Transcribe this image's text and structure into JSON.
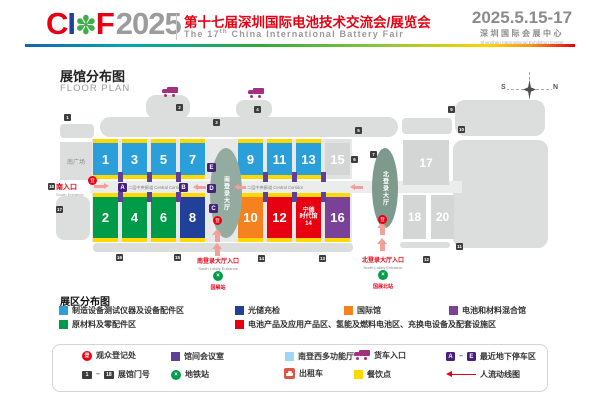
{
  "header": {
    "logo": {
      "c": "C",
      "i": "I",
      "flower": "✽",
      "f": "F",
      "year": "2025"
    },
    "title_cn": "第十七届深圳国际电池技术交流会/展览会",
    "title_en_prefix": "The 17",
    "title_en_sup": "th",
    "title_en_suffix": " China International Battery Fair",
    "date": "2025.5.15-17",
    "venue_cn": "深圳国际会展中心",
    "venue_en": "Shenzhen International Exhibition Center"
  },
  "floorplan": {
    "title_cn": "展馆分布图",
    "title_en": "FLOOR PLAN",
    "compass": {
      "s": "S",
      "n": "N"
    },
    "south_plaza": "南广场",
    "corridor_label": "二层中央廊道 Central Corridor",
    "south_entrance": {
      "cn": "南入口",
      "en": "South Entrance"
    },
    "south_lobby": "南登录大厅",
    "north_lobby": "北登录大厅",
    "south_lobby_entrance": {
      "cn": "南登录大厅入口",
      "en": "South Lobby Entrance",
      "metro": "国展站"
    },
    "north_lobby_entrance": {
      "cn": "北登录大厅入口",
      "en": "North Lobby Entrance",
      "metro": "国展北站"
    },
    "reg_glyph": "登",
    "metro_glyph": "×",
    "colors": {
      "blue": "#2b9fd9",
      "gray": "#d3d6d5",
      "green": "#009b48",
      "darkblue": "#21409a",
      "orange": "#f6821f",
      "red": "#e60012",
      "purple": "#7a4199",
      "yellow": "#ffd800",
      "conference": "#5c4099",
      "parking": "#45217c",
      "registration": "#e60012",
      "truck": "#a3307e",
      "metro": "#009e49",
      "flow": "#e60012"
    },
    "halls": [
      {
        "n": "1",
        "x": 93,
        "row": "top",
        "color": "blue"
      },
      {
        "n": "3",
        "x": 122,
        "row": "top",
        "color": "blue"
      },
      {
        "n": "5",
        "x": 151,
        "row": "top",
        "color": "blue"
      },
      {
        "n": "7",
        "x": 180,
        "row": "top",
        "color": "blue"
      },
      {
        "n": "9",
        "x": 238,
        "row": "top",
        "color": "blue"
      },
      {
        "n": "11",
        "x": 267,
        "row": "top",
        "color": "blue"
      },
      {
        "n": "13",
        "x": 296,
        "row": "top",
        "color": "blue"
      },
      {
        "n": "15",
        "x": 325,
        "row": "top",
        "color": "gray",
        "inactive": true
      },
      {
        "n": "2",
        "x": 93,
        "row": "bottom",
        "color": "green"
      },
      {
        "n": "4",
        "x": 122,
        "row": "bottom",
        "color": "green"
      },
      {
        "n": "6",
        "x": 151,
        "row": "bottom",
        "color": "green"
      },
      {
        "n": "8",
        "x": 180,
        "row": "bottom",
        "color": "darkblue"
      },
      {
        "n": "10",
        "x": 238,
        "row": "bottom",
        "color": "orange"
      },
      {
        "n": "12",
        "x": 267,
        "row": "bottom",
        "color": "red"
      },
      {
        "n": "14",
        "x": 296,
        "row": "bottom",
        "color": "red",
        "lines": [
          "宁德",
          "时代馆",
          "14"
        ]
      },
      {
        "n": "16",
        "x": 325,
        "row": "bottom",
        "color": "purple"
      }
    ],
    "gray_halls": [
      {
        "n": "17",
        "x": 403,
        "y": 140,
        "w": 46,
        "h": 45
      },
      {
        "n": "18",
        "x": 403,
        "y": 195,
        "w": 23,
        "h": 44
      },
      {
        "n": "20",
        "x": 431,
        "y": 195,
        "w": 23,
        "h": 44
      }
    ],
    "connector_xs": [
      118,
      147,
      176,
      263,
      292,
      321
    ],
    "gates": [
      {
        "n": "1",
        "x": 64,
        "y": 114
      },
      {
        "n": "2",
        "x": 176,
        "y": 104
      },
      {
        "n": "3",
        "x": 213,
        "y": 119
      },
      {
        "n": "4",
        "x": 254,
        "y": 106
      },
      {
        "n": "5",
        "x": 355,
        "y": 127
      },
      {
        "n": "6",
        "x": 351,
        "y": 156
      },
      {
        "n": "7",
        "x": 370,
        "y": 151
      },
      {
        "n": "9",
        "x": 448,
        "y": 106
      },
      {
        "n": "10",
        "x": 458,
        "y": 126
      },
      {
        "n": "11",
        "x": 456,
        "y": 243
      },
      {
        "n": "12",
        "x": 423,
        "y": 256
      },
      {
        "n": "13",
        "x": 319,
        "y": 255
      },
      {
        "n": "14",
        "x": 258,
        "y": 255
      },
      {
        "n": "15",
        "x": 174,
        "y": 254
      },
      {
        "n": "16",
        "x": 116,
        "y": 254
      },
      {
        "n": "17",
        "x": 56,
        "y": 206
      },
      {
        "n": "18",
        "x": 48,
        "y": 183
      }
    ],
    "parking": [
      {
        "l": "A",
        "x": 118,
        "y": 183
      },
      {
        "l": "B",
        "x": 179,
        "y": 183
      },
      {
        "l": "C",
        "x": 209,
        "y": 204
      },
      {
        "l": "D",
        "x": 207,
        "y": 184
      },
      {
        "l": "E",
        "x": 207,
        "y": 163
      }
    ],
    "registration_points": [
      {
        "x": 88,
        "y": 176
      },
      {
        "x": 213,
        "y": 216
      },
      {
        "x": 378,
        "y": 215
      }
    ],
    "trucks": [
      {
        "x": 162,
        "y": 87
      },
      {
        "x": 248,
        "y": 88
      }
    ],
    "flow_arrows": [
      {
        "x": 94,
        "y": 183,
        "dir": "right",
        "len": 15
      },
      {
        "x": 193,
        "y": 184,
        "dir": "left",
        "len": 13
      },
      {
        "x": 234,
        "y": 184,
        "dir": "left",
        "len": 12
      },
      {
        "x": 350,
        "y": 184,
        "dir": "left",
        "len": 13
      }
    ],
    "up_arrows": [
      {
        "x": 212,
        "y": 229
      },
      {
        "x": 212,
        "y": 243
      },
      {
        "x": 377,
        "y": 222
      },
      {
        "x": 377,
        "y": 238
      }
    ]
  },
  "legend": {
    "title": "展区分布图",
    "items": [
      {
        "color": "#2b9fd9",
        "label": "制造设备测试仪器及设备配件区"
      },
      {
        "color": "#21409a",
        "label": "光储充检"
      },
      {
        "color": "#f6821f",
        "label": "国际馆"
      },
      {
        "color": "#7a4199",
        "label": "电池和材料混合馆"
      },
      {
        "color": "#009b48",
        "label": "原材料及零配件区"
      },
      {
        "color": "#e60012",
        "label": "电池产品及应用产品区、氢能及燃料电池区、充换电设备及配套设施区"
      }
    ]
  },
  "footer": {
    "reg_glyph": "登",
    "reg": "观众登记处",
    "conference": "馆间会议室",
    "multifunction": "南登西多功能厅",
    "truck": "货车入口",
    "parking_a": "A",
    "parking_e": "E",
    "parking": "最近地下停车区",
    "gate_first": "1",
    "gate_last": "18",
    "gates": "展馆门号",
    "metro": "地铁站",
    "taxi": "出租车",
    "food": "餐饮点",
    "flow": "人流动线图",
    "dash": "–"
  }
}
